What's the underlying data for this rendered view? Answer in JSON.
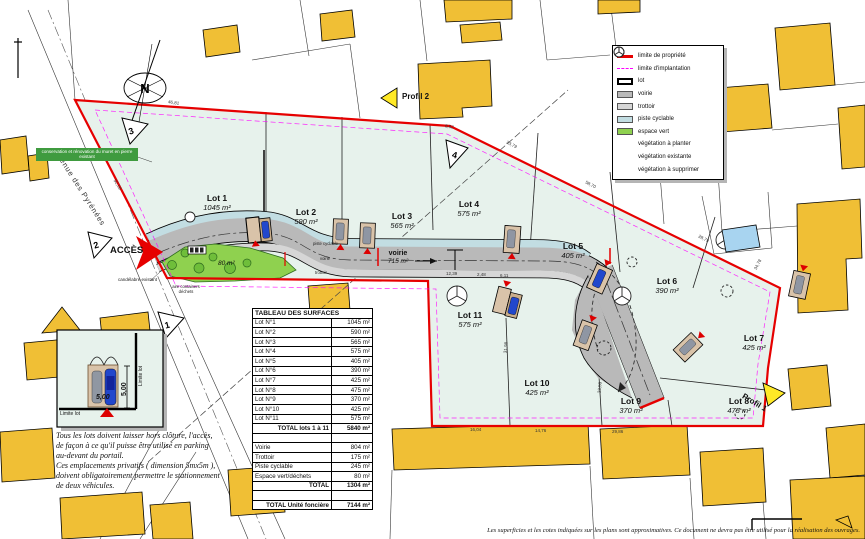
{
  "colors": {
    "boundary_red": "#e60000",
    "implantation_magenta": "#ff00ff",
    "lot_fill": "#e7f2ec",
    "espace_vert": "#8fd14f",
    "piste_cyclable": "#c2dde2",
    "voirie_gray": "#b9b9b9",
    "trottoir_gray": "#d6d6d6",
    "building_yellow": "#f0bf35",
    "pool_blue": "#a8d4f0"
  },
  "legend": {
    "items": [
      {
        "label": "limite de propriété"
      },
      {
        "label": "limite d'implantation"
      },
      {
        "label": "lot"
      },
      {
        "label": "voirie"
      },
      {
        "label": "trottoir"
      },
      {
        "label": "piste cyclable"
      },
      {
        "label": "espace vert"
      },
      {
        "label": "végétation à planter"
      },
      {
        "label": "végétation existante"
      },
      {
        "label": "végétation à supprimer"
      }
    ]
  },
  "table": {
    "title": "TABLEAU DES SURFACES",
    "lots": [
      {
        "label": "Lot N°1",
        "value": "1045 m²"
      },
      {
        "label": "Lot N°2",
        "value": "590 m²"
      },
      {
        "label": "Lot N°3",
        "value": "565 m²"
      },
      {
        "label": "Lot N°4",
        "value": "575 m²"
      },
      {
        "label": "Lot N°5",
        "value": "405 m²"
      },
      {
        "label": "Lot N°6",
        "value": "390 m²"
      },
      {
        "label": "Lot N°7",
        "value": "425 m²"
      },
      {
        "label": "Lot N°8",
        "value": "475 m²"
      },
      {
        "label": "Lot N°9",
        "value": "370 m²"
      },
      {
        "label": "Lot N°10",
        "value": "425 m²"
      },
      {
        "label": "Lot N°11",
        "value": "575 m²"
      }
    ],
    "total_lots": {
      "label": "TOTAL lots 1 à 11",
      "value": "5840 m²"
    },
    "infra": [
      {
        "label": "Voirie",
        "value": "804 m²"
      },
      {
        "label": "Trottoir",
        "value": "175 m²"
      },
      {
        "label": "Piste cyclable",
        "value": "245 m²"
      },
      {
        "label": "Espace vert/déchets",
        "value": "80 m²"
      }
    ],
    "total_infra": {
      "label": "TOTAL",
      "value": "1304 m²"
    },
    "total_unit": {
      "label": "TOTAL Unité foncière",
      "value": "7144 m²"
    }
  },
  "plan": {
    "access": "ACCÈS",
    "street": "Avenue des Pyrénées",
    "profil_1": "Profil 1",
    "profil_2": "Profil 2",
    "compass": "N",
    "road_label": "voirie",
    "road_area": "715 m²",
    "espace_vert_area": "80 m²",
    "bands": {
      "piste": "piste cyclable",
      "voirie": "voirie",
      "trottoir": "trottoir"
    },
    "conservation_note": "conservation et rénovation du muret en pierre existant",
    "candelabre_note": "candélabre existant",
    "containers_note": "aire containers déchets",
    "markers": {
      "m1": "1",
      "m2": "2",
      "m3": "3",
      "m4": "4"
    },
    "lots": [
      {
        "name": "Lot 1",
        "area": "1045 m²"
      },
      {
        "name": "Lot 2",
        "area": "590 m²"
      },
      {
        "name": "Lot 3",
        "area": "565 m²"
      },
      {
        "name": "Lot 4",
        "area": "575 m²"
      },
      {
        "name": "Lot 5",
        "area": "405 m²"
      },
      {
        "name": "Lot 6",
        "area": "390 m²"
      },
      {
        "name": "Lot 7",
        "area": "425 m²"
      },
      {
        "name": "Lot 8",
        "area": "475 m²"
      },
      {
        "name": "Lot 9",
        "area": "370 m²"
      },
      {
        "name": "Lot 10",
        "area": "425 m²"
      },
      {
        "name": "Lot 11",
        "area": "575 m²"
      }
    ]
  },
  "inset": {
    "limite_lot_v": "Limite lot",
    "limite_lot_h": "Limite lot",
    "dim_w": "5,00",
    "dim_h": "5,00"
  },
  "notes": {
    "lines": [
      "Tous les lots doivent laisser hors clôture, l'accès,",
      "de façon à ce qu'il puisse être utilisé en parking",
      "au-devant du portail.",
      "Ces emplacements privatifs ( dimension 5mx5m ),",
      "doivent obligatoirement permettre le stationnement",
      "de deux véhicules."
    ]
  },
  "disclaimer": "Les superficies et les cotes indiquées sur les plans sont approximatives. Ce document ne devra pas être utilisé pour la réalisation des ouvrages.",
  "dims": [
    "92,59",
    "46,81",
    "8,52",
    "23,79",
    "58,70",
    "28,79",
    "16,04",
    "14,76",
    "29,86",
    "12,39",
    "2,48",
    "6,11",
    "31,98",
    "23,50",
    "34,78"
  ]
}
